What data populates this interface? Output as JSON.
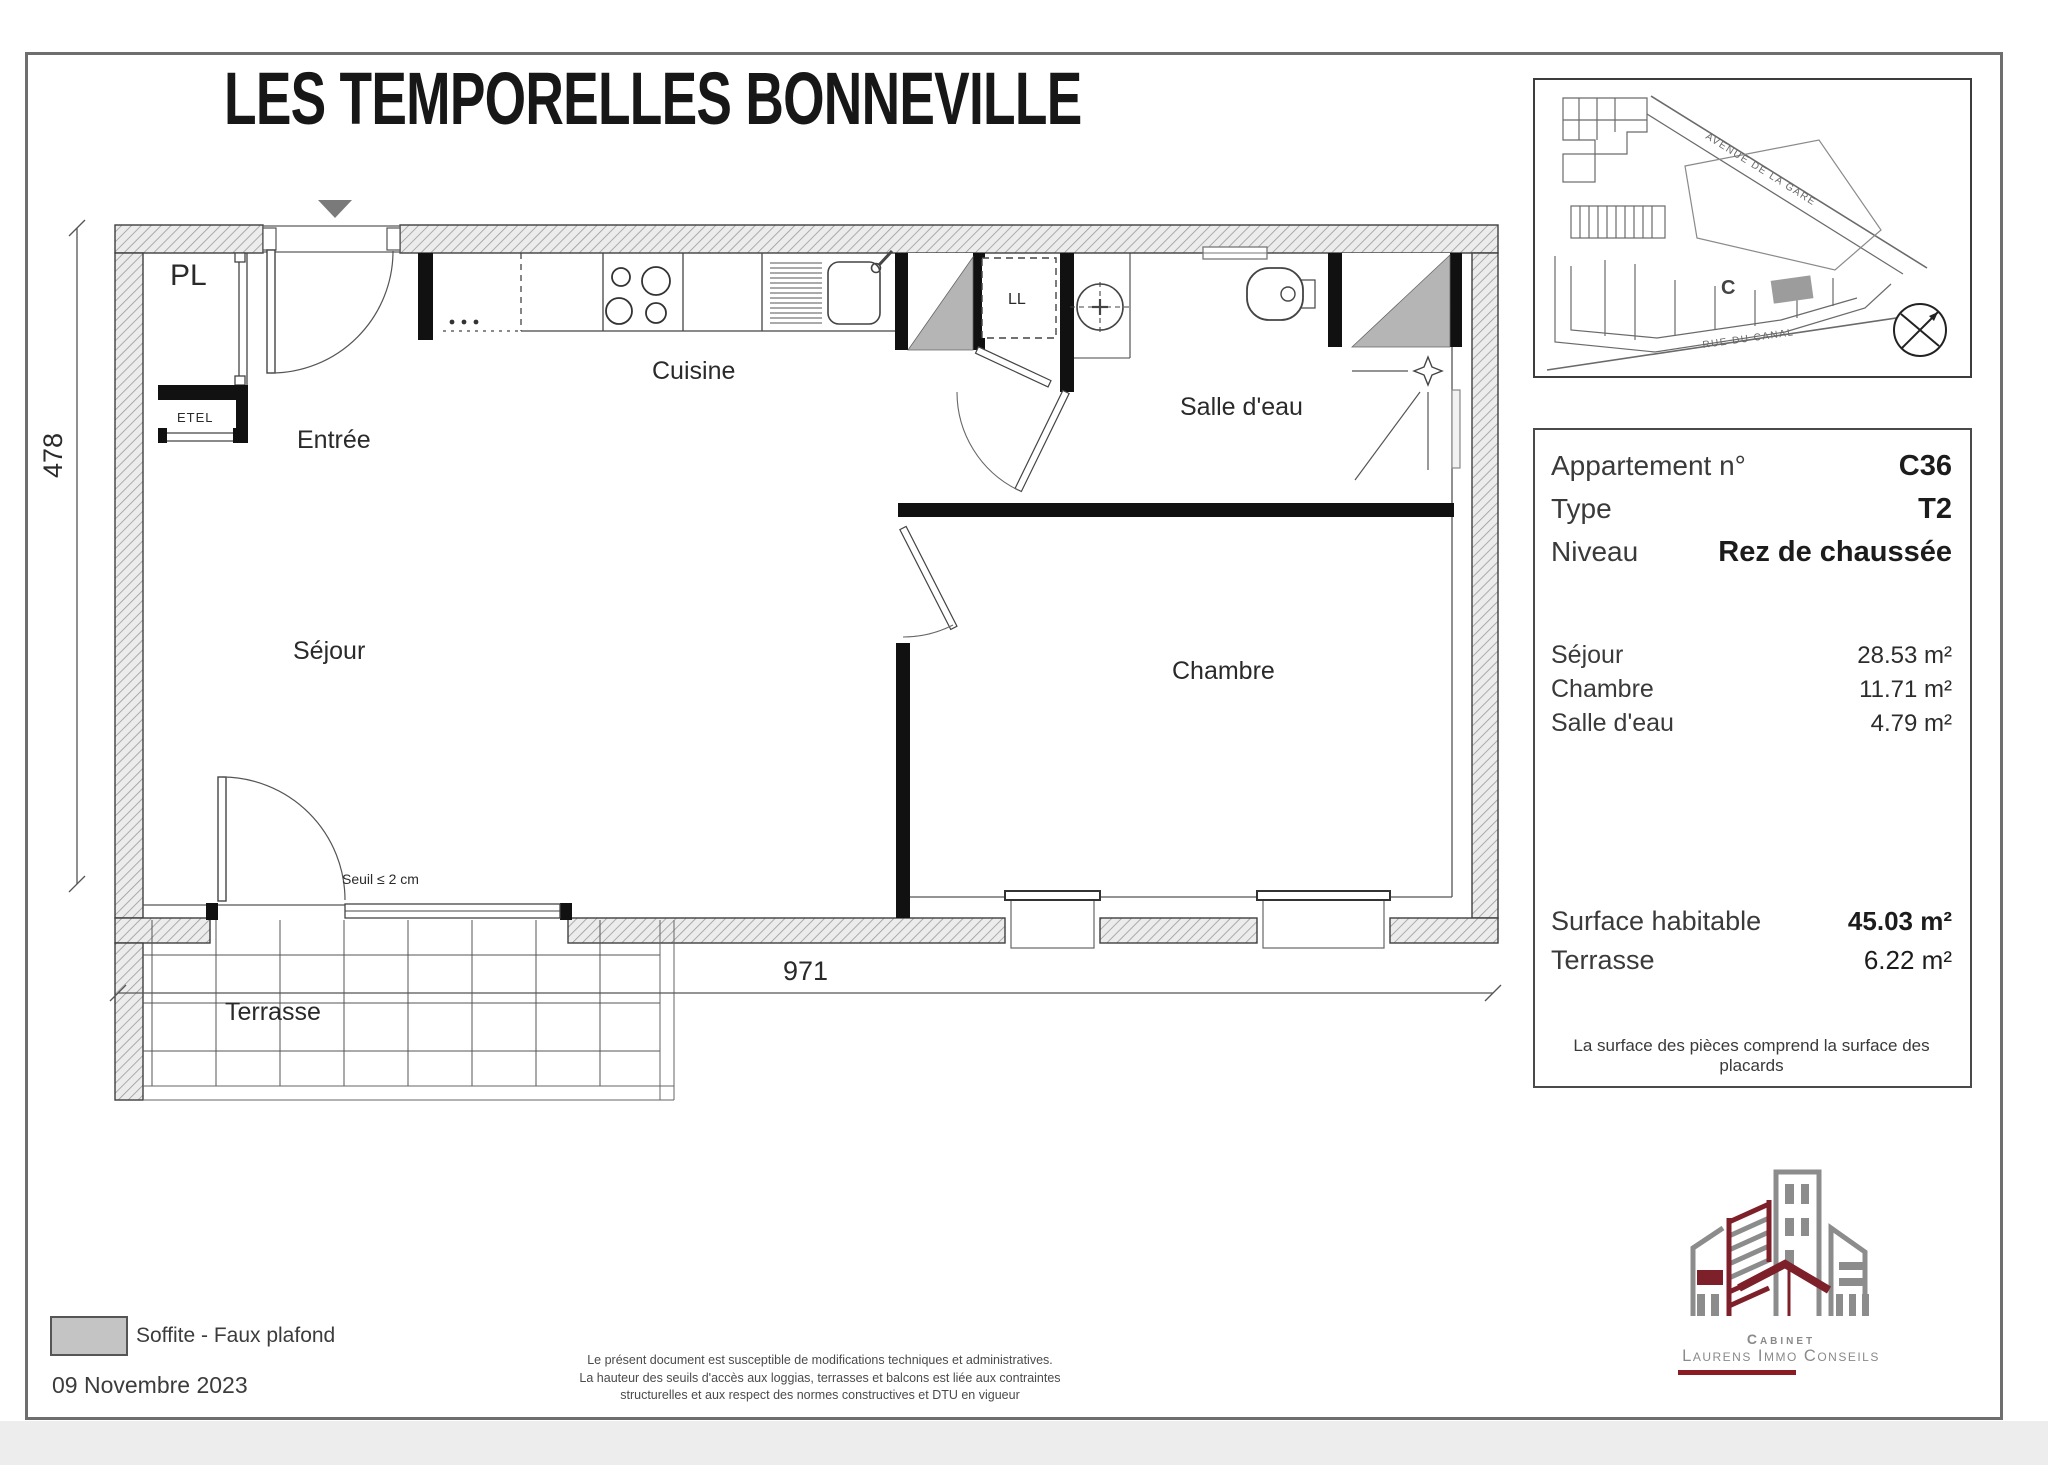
{
  "title": "LES TEMPORELLES BONNEVILLE",
  "plan": {
    "rooms": {
      "pl": "PL",
      "etel": "ETEL",
      "entree": "Entrée",
      "cuisine": "Cuisine",
      "ll": "LL",
      "salle_deau": "Salle d'eau",
      "sejour": "Séjour",
      "chambre": "Chambre",
      "terrasse": "Terrasse"
    },
    "seuil_note": "Seuil ≤ 2 cm",
    "dim_width": "971",
    "dim_height": "478"
  },
  "site_map": {
    "street_top": "AVENUE DE LA GARE",
    "street_bottom": "RUE DU CANAL",
    "building_label": "C"
  },
  "info_panel": {
    "apartment_label": "Appartement n°",
    "apartment_value": "C36",
    "type_label": "Type",
    "type_value": "T2",
    "level_label": "Niveau",
    "level_value": "Rez de chaussée",
    "areas": [
      {
        "label": "Séjour",
        "value": "28.53 m²"
      },
      {
        "label": "Chambre",
        "value": "11.71 m²"
      },
      {
        "label": "Salle d'eau",
        "value": "4.79 m²"
      }
    ],
    "surface_label": "Surface habitable",
    "surface_value": "45.03 m²",
    "terrace_label": "Terrasse",
    "terrace_value": "6.22 m²",
    "note": "La surface des pièces comprend la surface des placards"
  },
  "legend": {
    "swatch_label": "Soffite - Faux plafond",
    "date": "09 Novembre 2023"
  },
  "disclaimer": [
    "Le présent document est susceptible de modifications techniques et administratives.",
    "La hauteur des seuils d'accès aux loggias, terrasses et balcons est liée aux contraintes",
    "structurelles et aux respect des normes constructives et DTU en vigueur"
  ],
  "logo": {
    "line1": "Cabinet",
    "line2": "Laurens Immo Conseils"
  },
  "colors": {
    "accent": "#8b1c24",
    "soffite": "#b5b5b5",
    "wall_hatch": "#9a9a9a"
  }
}
